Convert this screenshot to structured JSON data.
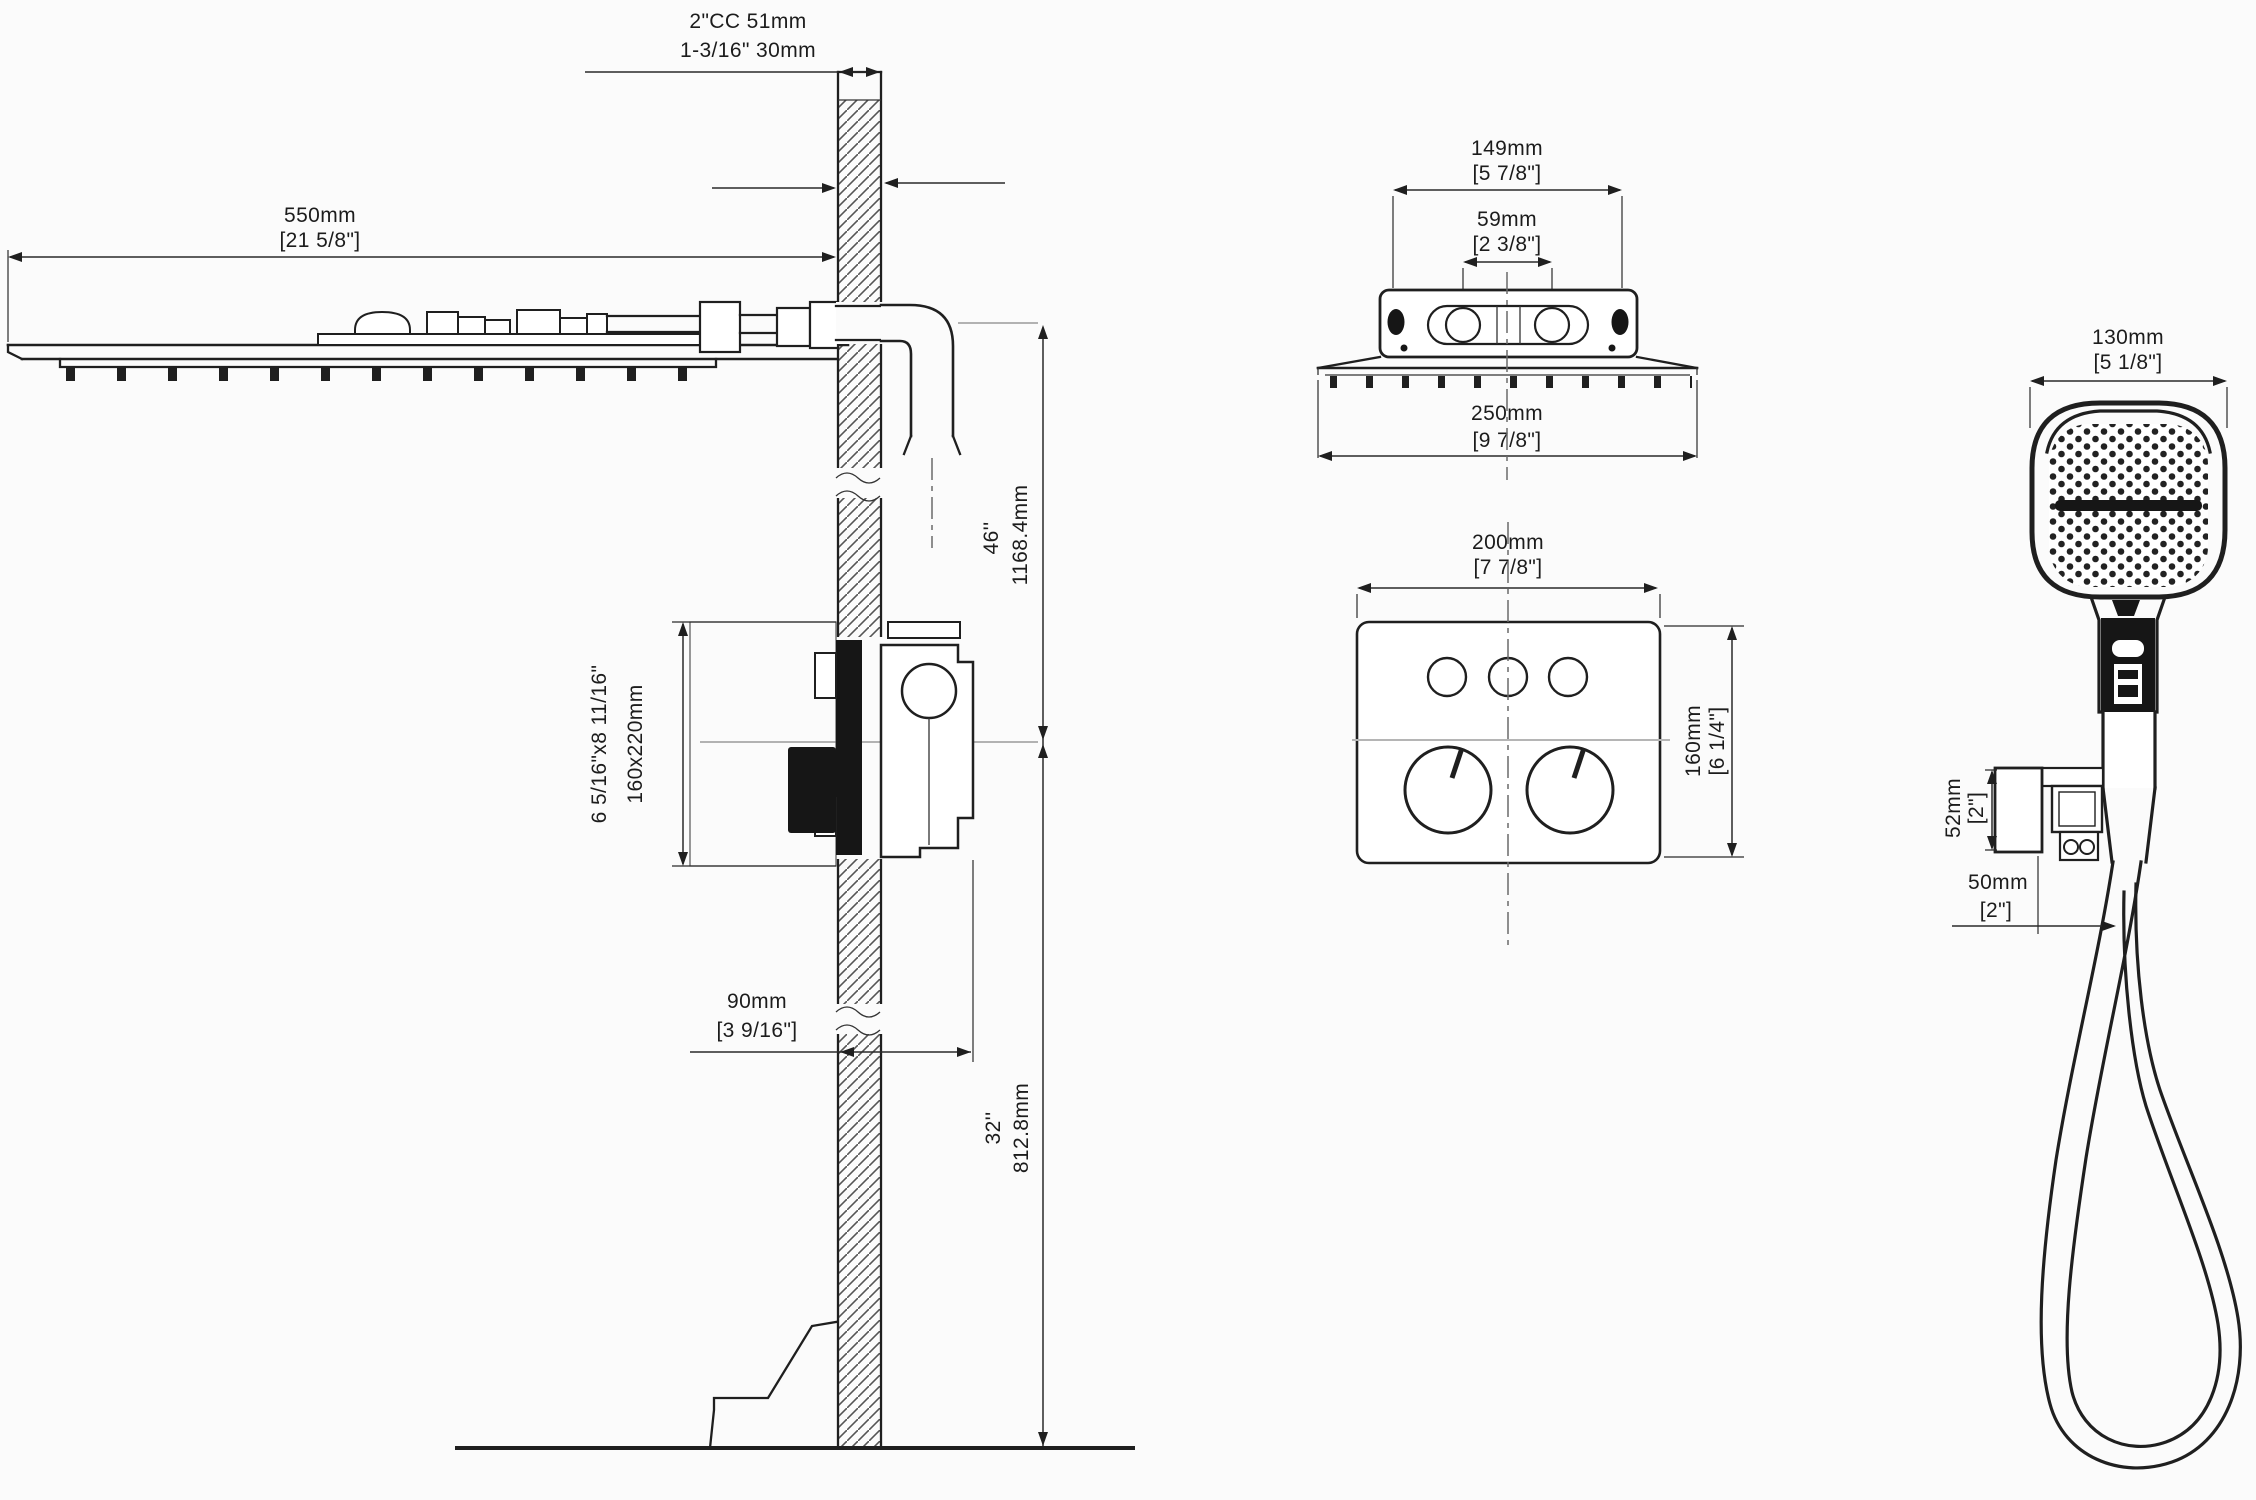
{
  "colors": {
    "ink": "#1f1f1f",
    "paper": "#fbfbfb"
  },
  "drawing": {
    "side": {
      "wall_note_line1": "2\"CC 51mm",
      "wall_note_line2": "1-3/16\" 30mm",
      "head_width_mm": "550mm",
      "head_width_in": "[21 5/8\"]",
      "arm_height_in": "46''",
      "arm_height_mm": "1168.4mm",
      "plate_size_in": "6 5/16\"x8 11/16\"",
      "plate_size_mm": "160x220mm",
      "valve_depth_mm": "90mm",
      "valve_depth_in": "[3 9/16\"]",
      "valve_height_in": "32''",
      "valve_height_mm": "812.8mm"
    },
    "back": {
      "bracket_width_mm": "149mm",
      "bracket_width_in": "[5 7/8\"]",
      "inlet_spacing_mm": "59mm",
      "inlet_spacing_in": "[2 3/8\"]",
      "head_depth_mm": "250mm",
      "head_depth_in": "[9 7/8\"]"
    },
    "trim": {
      "width_mm": "200mm",
      "width_in": "[7 7/8\"]",
      "height_mm": "160mm",
      "height_in": "[6 1/4\"]"
    },
    "hand": {
      "head_width_mm": "130mm",
      "head_width_in": "[5 1/8\"]",
      "holder_height_mm": "52mm",
      "holder_height_in": "[2\"]",
      "holder_depth_mm": "50mm",
      "holder_depth_in": "[2\"]"
    }
  }
}
